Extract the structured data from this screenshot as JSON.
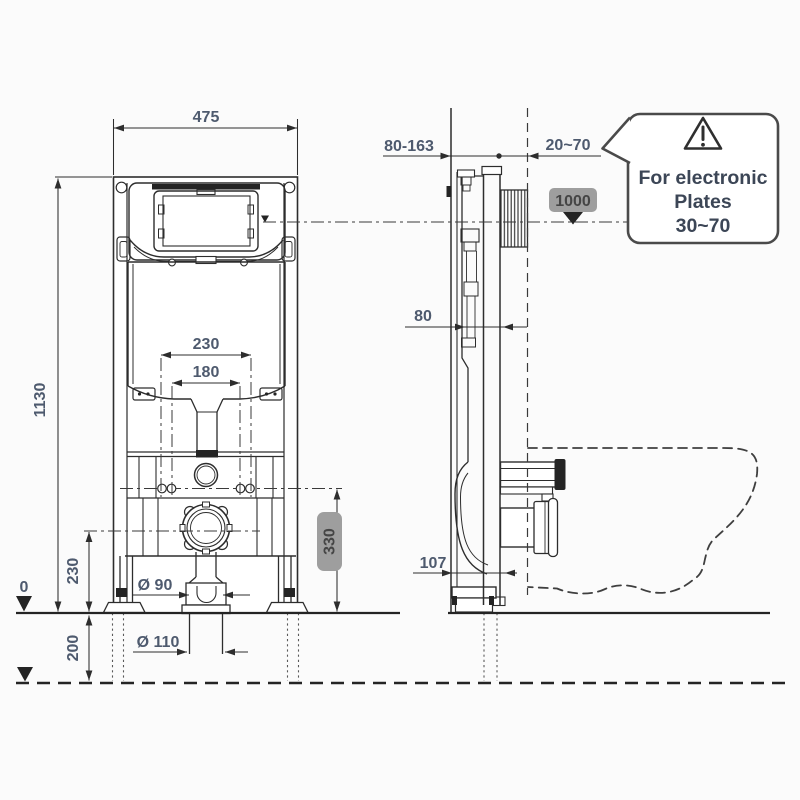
{
  "colors": {
    "line": "#2d2d2d",
    "dim_text": "#4e5a6e",
    "badge_bg": "#9e9e9e",
    "badge_text": "#454545",
    "callout_text": "#3c4656"
  },
  "front_view": {
    "dim_width": "475",
    "dim_height": "1130",
    "dim_bolt_spacing_outer": "230",
    "dim_bolt_spacing_inner": "180",
    "dim_outlet_height": "230",
    "dim_below_floor": "200",
    "floor_level": "0",
    "dia_outlet": "Ø 90",
    "dia_waste_pipe": "Ø 110",
    "badge_bolt_height": "330"
  },
  "side_view": {
    "dim_depth_adjust": "80-163",
    "dim_plate_depth": "20~70",
    "dim_frame_depth": "80",
    "dim_outlet_offset": "107",
    "badge_level": "1000"
  },
  "callout": {
    "line1": "For electronic",
    "line2": "Plates",
    "line3": "30~70"
  }
}
